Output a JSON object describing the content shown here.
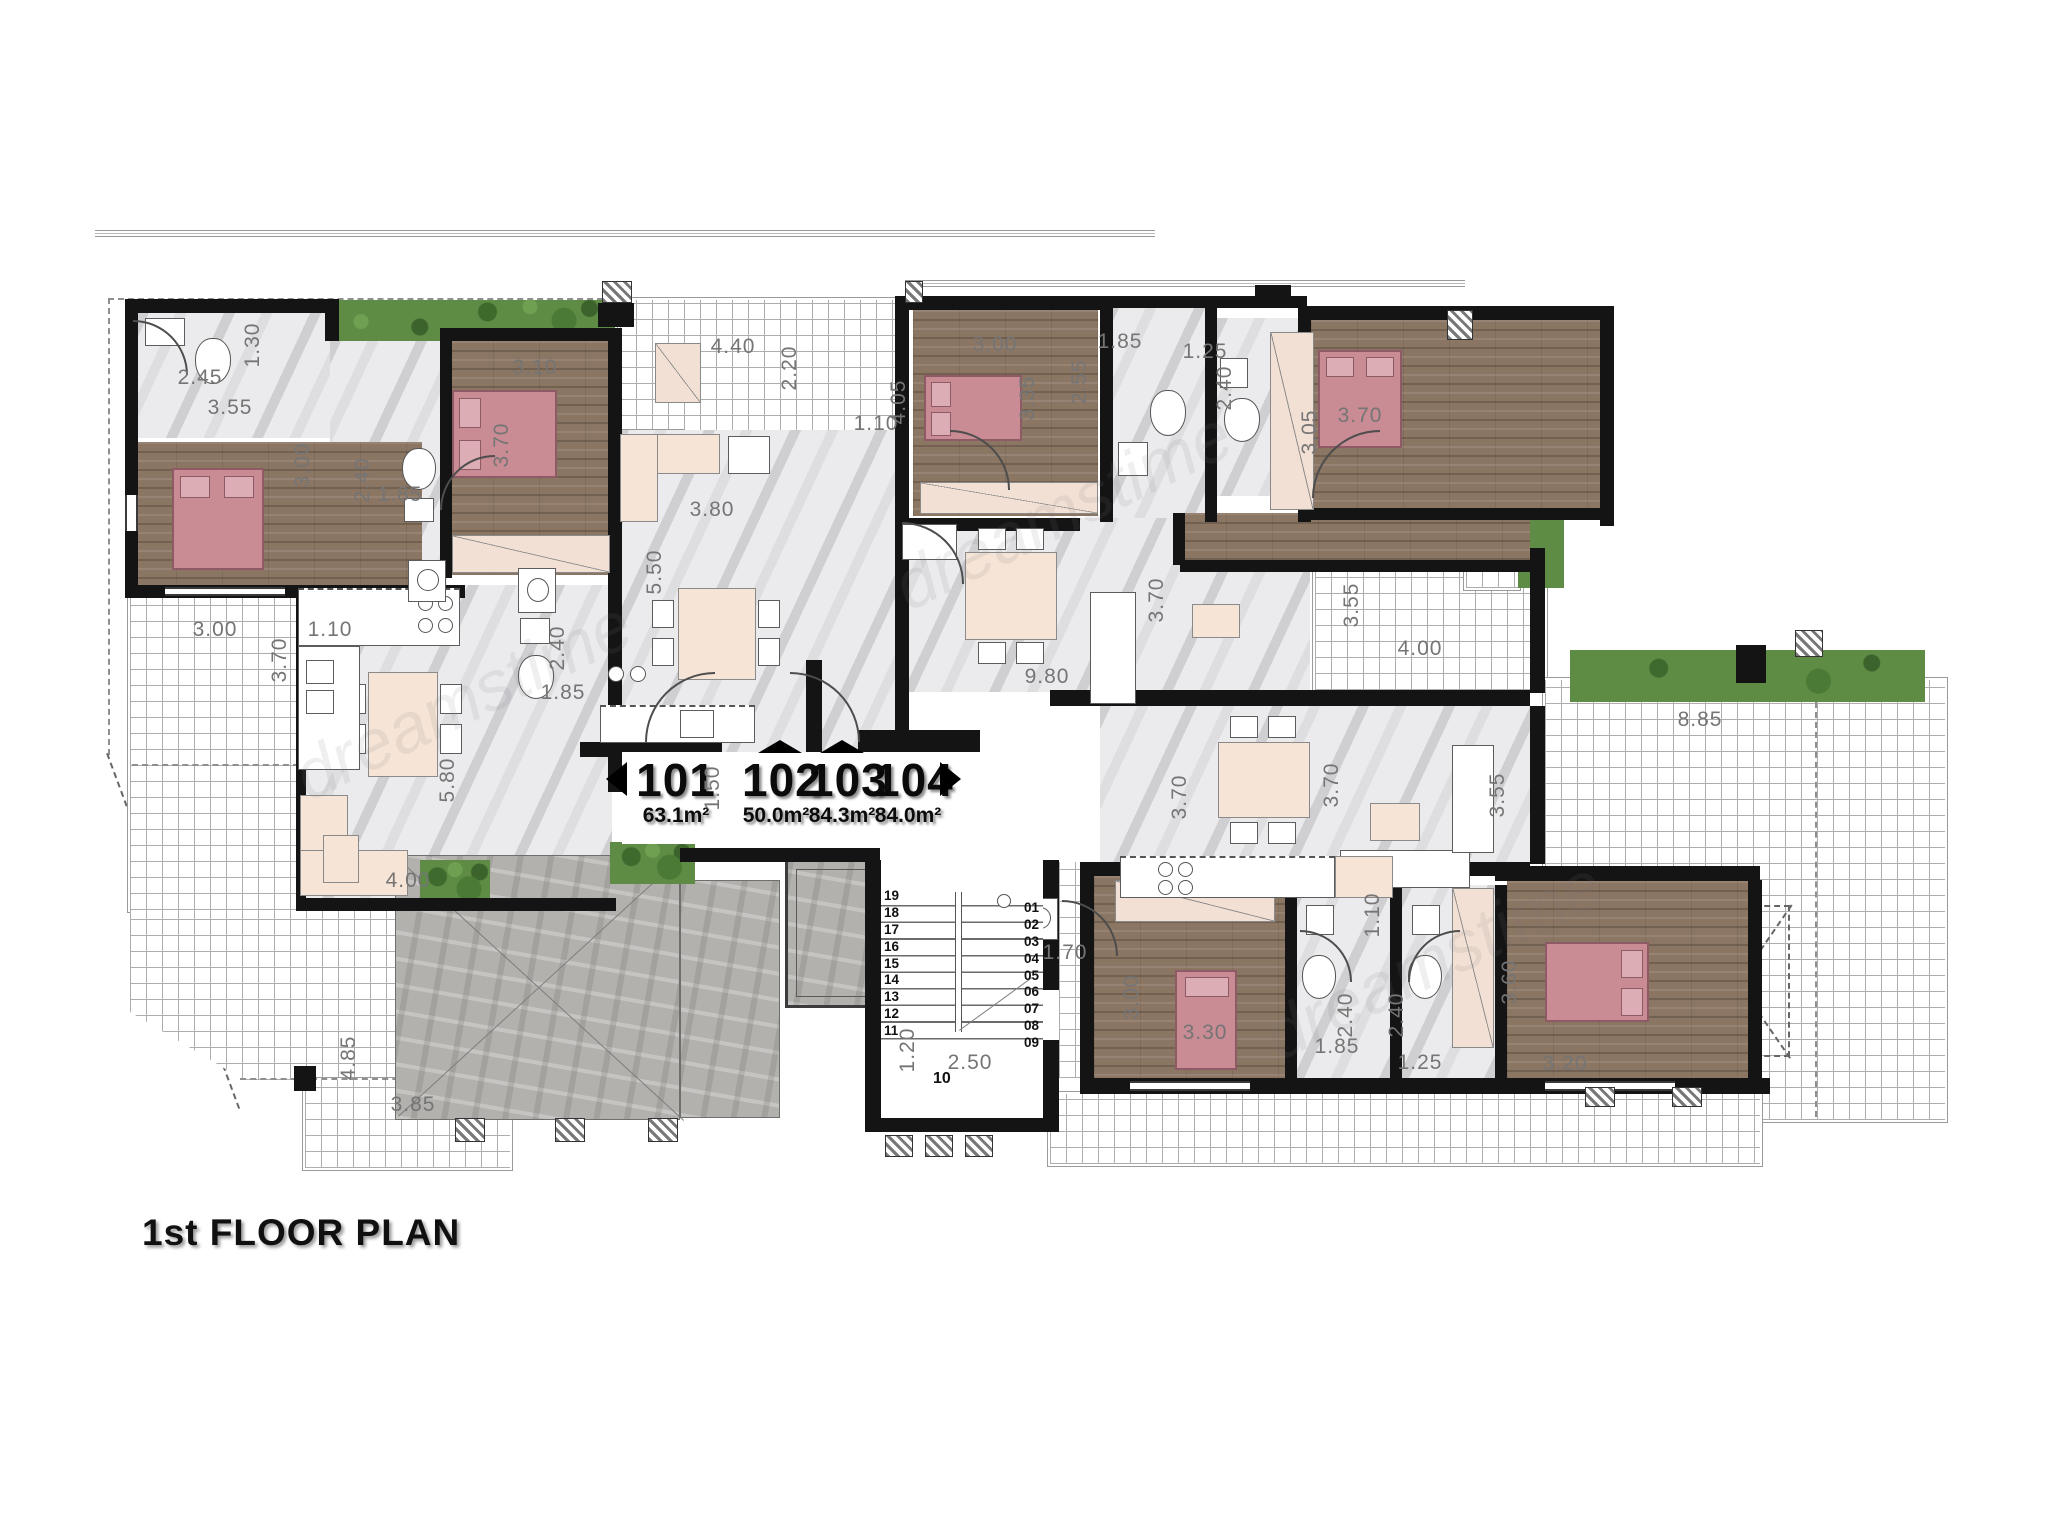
{
  "title": "1st FLOOR PLAN",
  "watermark": "dreamstime",
  "units": [
    {
      "id": "101",
      "area": "63.1m²"
    },
    {
      "id": "102",
      "area": "50.0m²"
    },
    {
      "id": "103",
      "area": "84.3m²"
    },
    {
      "id": "104",
      "area": "84.0m²"
    }
  ],
  "stairs": {
    "left": [
      "19",
      "18",
      "17",
      "16",
      "15",
      "14",
      "13",
      "12",
      "11"
    ],
    "right": [
      "01",
      "02",
      "03",
      "04",
      "05",
      "06",
      "07",
      "08",
      "09"
    ],
    "bottom": "10"
  },
  "colors": {
    "wall": "#141414",
    "wood": "#8b7563",
    "bed": "#c98b94",
    "bed_border": "#8d5a65",
    "marble": "#ebebed",
    "grass": "#5f8c45",
    "furniture": "#f6e4d6",
    "concrete": "#b3b1ae",
    "dim_text": "#757575"
  },
  "dimensions": [
    {
      "v": "2.45",
      "x": 200,
      "y": 378,
      "o": "h"
    },
    {
      "v": "1.30",
      "x": 253,
      "y": 345,
      "o": "v"
    },
    {
      "v": "3.55",
      "x": 230,
      "y": 408,
      "o": "h"
    },
    {
      "v": "3.00",
      "x": 303,
      "y": 465,
      "o": "v"
    },
    {
      "v": "2.40",
      "x": 363,
      "y": 480,
      "o": "v"
    },
    {
      "v": "1.85",
      "x": 400,
      "y": 495,
      "o": "h"
    },
    {
      "v": "3.10",
      "x": 535,
      "y": 368,
      "o": "h"
    },
    {
      "v": "3.70",
      "x": 502,
      "y": 445,
      "o": "v"
    },
    {
      "v": "4.40",
      "x": 733,
      "y": 347,
      "o": "h"
    },
    {
      "v": "2.20",
      "x": 790,
      "y": 368,
      "o": "v"
    },
    {
      "v": "3.80",
      "x": 712,
      "y": 510,
      "o": "h"
    },
    {
      "v": "5.50",
      "x": 655,
      "y": 572,
      "o": "v"
    },
    {
      "v": "1.10",
      "x": 876,
      "y": 424,
      "o": "h"
    },
    {
      "v": "4.05",
      "x": 899,
      "y": 402,
      "o": "v"
    },
    {
      "v": "3.00",
      "x": 995,
      "y": 345,
      "o": "h"
    },
    {
      "v": "3.35",
      "x": 1028,
      "y": 398,
      "o": "v"
    },
    {
      "v": "1.85",
      "x": 1120,
      "y": 342,
      "o": "h"
    },
    {
      "v": "2.55",
      "x": 1080,
      "y": 382,
      "o": "v"
    },
    {
      "v": "1.25",
      "x": 1205,
      "y": 352,
      "o": "h"
    },
    {
      "v": "2.40",
      "x": 1225,
      "y": 388,
      "o": "v"
    },
    {
      "v": "3.05",
      "x": 1310,
      "y": 432,
      "o": "v"
    },
    {
      "v": "3.70",
      "x": 1360,
      "y": 416,
      "o": "h"
    },
    {
      "v": "3.00",
      "x": 215,
      "y": 630,
      "o": "h"
    },
    {
      "v": "3.70",
      "x": 280,
      "y": 660,
      "o": "v"
    },
    {
      "v": "1.10",
      "x": 330,
      "y": 630,
      "o": "h"
    },
    {
      "v": "2.40",
      "x": 558,
      "y": 648,
      "o": "v"
    },
    {
      "v": "1.85",
      "x": 563,
      "y": 693,
      "o": "h"
    },
    {
      "v": "5.80",
      "x": 448,
      "y": 780,
      "o": "v"
    },
    {
      "v": "4.00",
      "x": 408,
      "y": 881,
      "o": "h"
    },
    {
      "v": "1.50",
      "x": 713,
      "y": 788,
      "o": "v"
    },
    {
      "v": "9.80",
      "x": 1047,
      "y": 677,
      "o": "h"
    },
    {
      "v": "3.70",
      "x": 1157,
      "y": 600,
      "o": "v"
    },
    {
      "v": "3.55",
      "x": 1352,
      "y": 605,
      "o": "v"
    },
    {
      "v": "4.00",
      "x": 1420,
      "y": 649,
      "o": "h"
    },
    {
      "v": "3.70",
      "x": 1180,
      "y": 797,
      "o": "v"
    },
    {
      "v": "3.70",
      "x": 1332,
      "y": 785,
      "o": "v"
    },
    {
      "v": "3.55",
      "x": 1498,
      "y": 795,
      "o": "v"
    },
    {
      "v": "8.85",
      "x": 1700,
      "y": 720,
      "o": "h"
    },
    {
      "v": "4.85",
      "x": 349,
      "y": 1058,
      "o": "v"
    },
    {
      "v": "3.85",
      "x": 413,
      "y": 1105,
      "o": "h"
    },
    {
      "v": "1.20",
      "x": 908,
      "y": 1050,
      "o": "v"
    },
    {
      "v": "2.50",
      "x": 970,
      "y": 1063,
      "o": "h"
    },
    {
      "v": "1.70",
      "x": 1065,
      "y": 953,
      "o": "h"
    },
    {
      "v": "3.00",
      "x": 1132,
      "y": 997,
      "o": "v"
    },
    {
      "v": "3.30",
      "x": 1205,
      "y": 1033,
      "o": "h"
    },
    {
      "v": "2.40",
      "x": 1346,
      "y": 1015,
      "o": "v"
    },
    {
      "v": "1.85",
      "x": 1337,
      "y": 1047,
      "o": "h"
    },
    {
      "v": "2.40",
      "x": 1397,
      "y": 1015,
      "o": "v"
    },
    {
      "v": "1.25",
      "x": 1420,
      "y": 1063,
      "o": "h"
    },
    {
      "v": "1.10",
      "x": 1373,
      "y": 915,
      "o": "v"
    },
    {
      "v": "3.60",
      "x": 1510,
      "y": 982,
      "o": "v"
    },
    {
      "v": "3.20",
      "x": 1565,
      "y": 1064,
      "o": "h"
    }
  ]
}
